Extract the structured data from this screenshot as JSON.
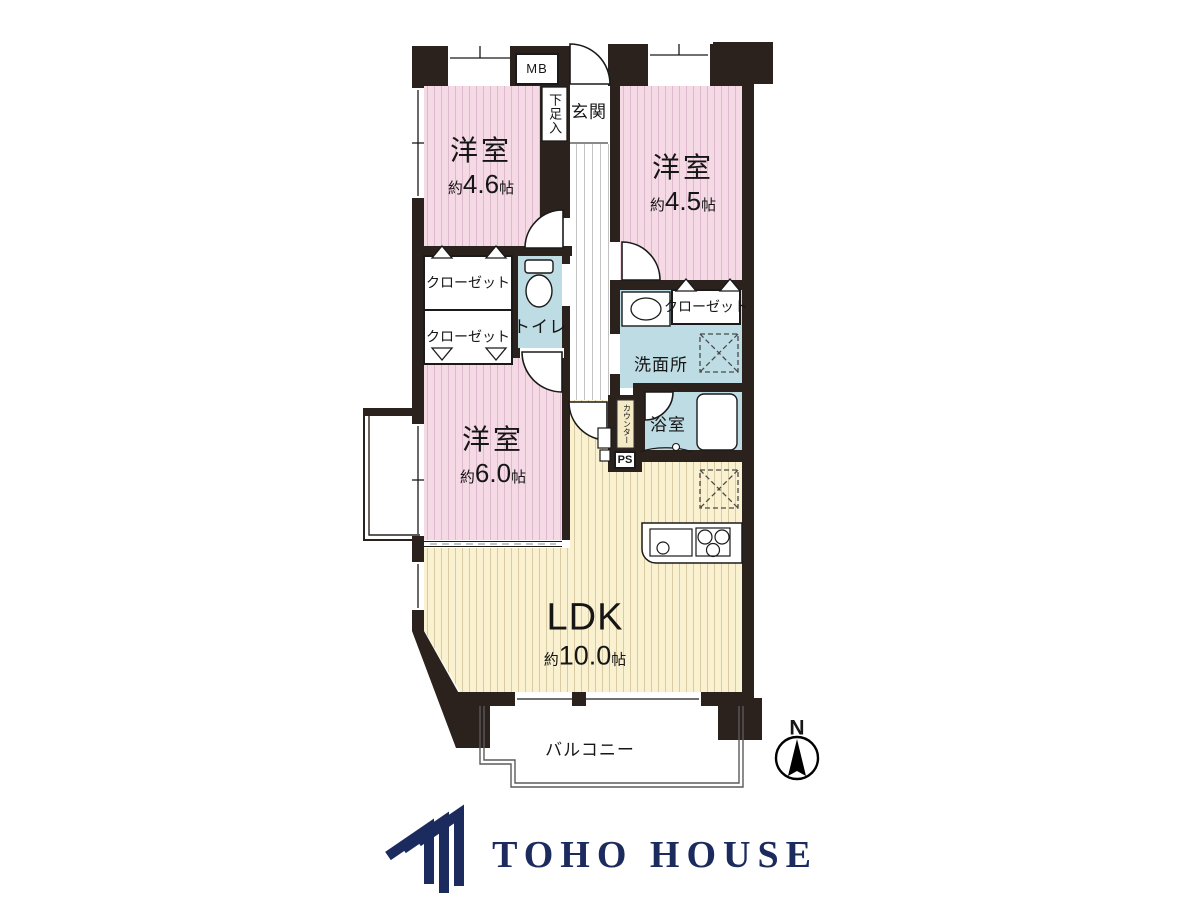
{
  "plan": {
    "room_4_6": {
      "name": "洋室",
      "prefix": "約",
      "value": "4.6",
      "unit": "帖"
    },
    "room_4_5": {
      "name": "洋室",
      "prefix": "約",
      "value": "4.5",
      "unit": "帖"
    },
    "room_6_0": {
      "name": "洋室",
      "prefix": "約",
      "value": "6.0",
      "unit": "帖"
    },
    "ldk": {
      "name": "LDK",
      "prefix": "約",
      "value": "10.0",
      "unit": "帖"
    },
    "labels": {
      "entrance": "玄関",
      "shoe_cabinet": "下足入",
      "meter_box": "MB",
      "closet_upper_left": "クローゼット",
      "closet_lower_left": "クローゼット",
      "closet_right": "クローゼット",
      "toilet": "トイレ",
      "washroom": "洗面所",
      "bathroom": "浴室",
      "counter": "カウンター",
      "pipe_space": "PS",
      "balcony": "バルコニー",
      "north": "N"
    }
  },
  "logo": {
    "text": "TOHO HOUSE"
  },
  "colors": {
    "room_pink": "#f5d9e4",
    "room_pink_stripe": "#ddb9cd",
    "ldk_cream": "#f9f1d0",
    "ldk_cream_stripe": "#d8cba4",
    "wet_blue": "#bedce3",
    "wall": "#2b211d",
    "logo_navy": "#1c2b5e"
  }
}
